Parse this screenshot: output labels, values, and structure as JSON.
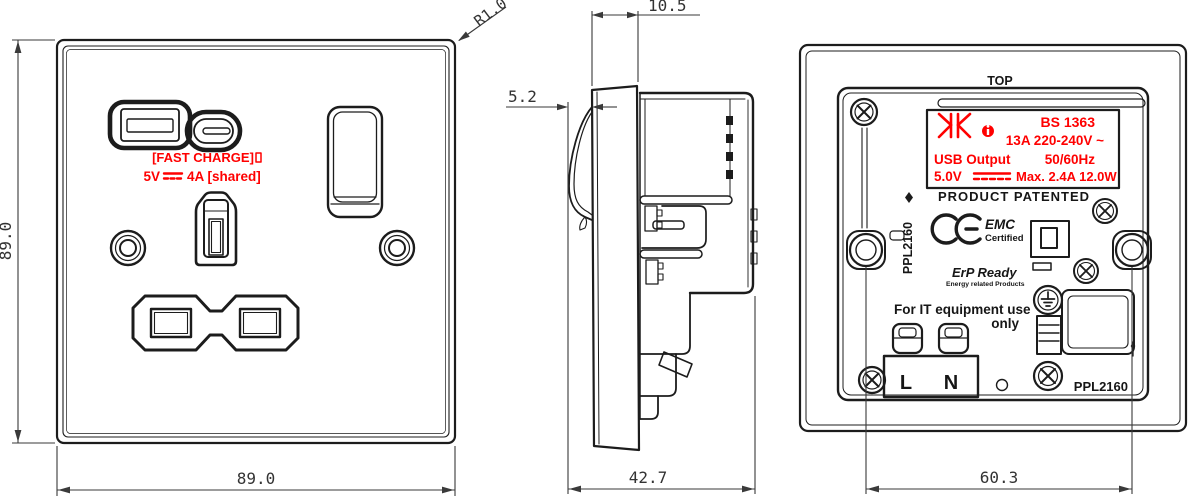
{
  "front": {
    "dim_height": "89.0",
    "dim_width": "89.0",
    "corner_radius": "R1.0",
    "fast_charge": "[FAST CHARGE]",
    "usb_v": "5V",
    "usb_a": "4A [shared]"
  },
  "side": {
    "depth_faceplate": "10.5",
    "depth_switch": "5.2",
    "depth_total": "42.7"
  },
  "back": {
    "top": "TOP",
    "label": {
      "standard": "BS 1363",
      "rating": "13A 220-240V ~",
      "usb_output": "USB Output",
      "frequency": "50/60Hz",
      "usb_voltage": "5.0V",
      "usb_max": "Max. 2.4A 12.0W"
    },
    "patented": "PRODUCT PATENTED",
    "emc": "EMC",
    "emc_sub": "Certified",
    "erp": "ErP Ready",
    "erp_sub": "Energy related Products",
    "it_use_1": "For IT equipment use",
    "it_use_2": "only",
    "terminal_live": "L",
    "terminal_neutral": "N",
    "model_vertical": "PPL2160",
    "model": "PPL2160",
    "dim_fixing_centres": "60.3"
  },
  "icons": {
    "dc_symbol": "⎓",
    "ac_symbol": "~",
    "info_mark": "i",
    "brand_logo": "KK",
    "ce_mark": "CE",
    "earth_symbol": "earth-ground",
    "screw_head": "phillips-cross"
  },
  "colors": {
    "line": "#1c1c1c",
    "accent_red": "#ff0000",
    "dim": "#3a3a3a"
  }
}
